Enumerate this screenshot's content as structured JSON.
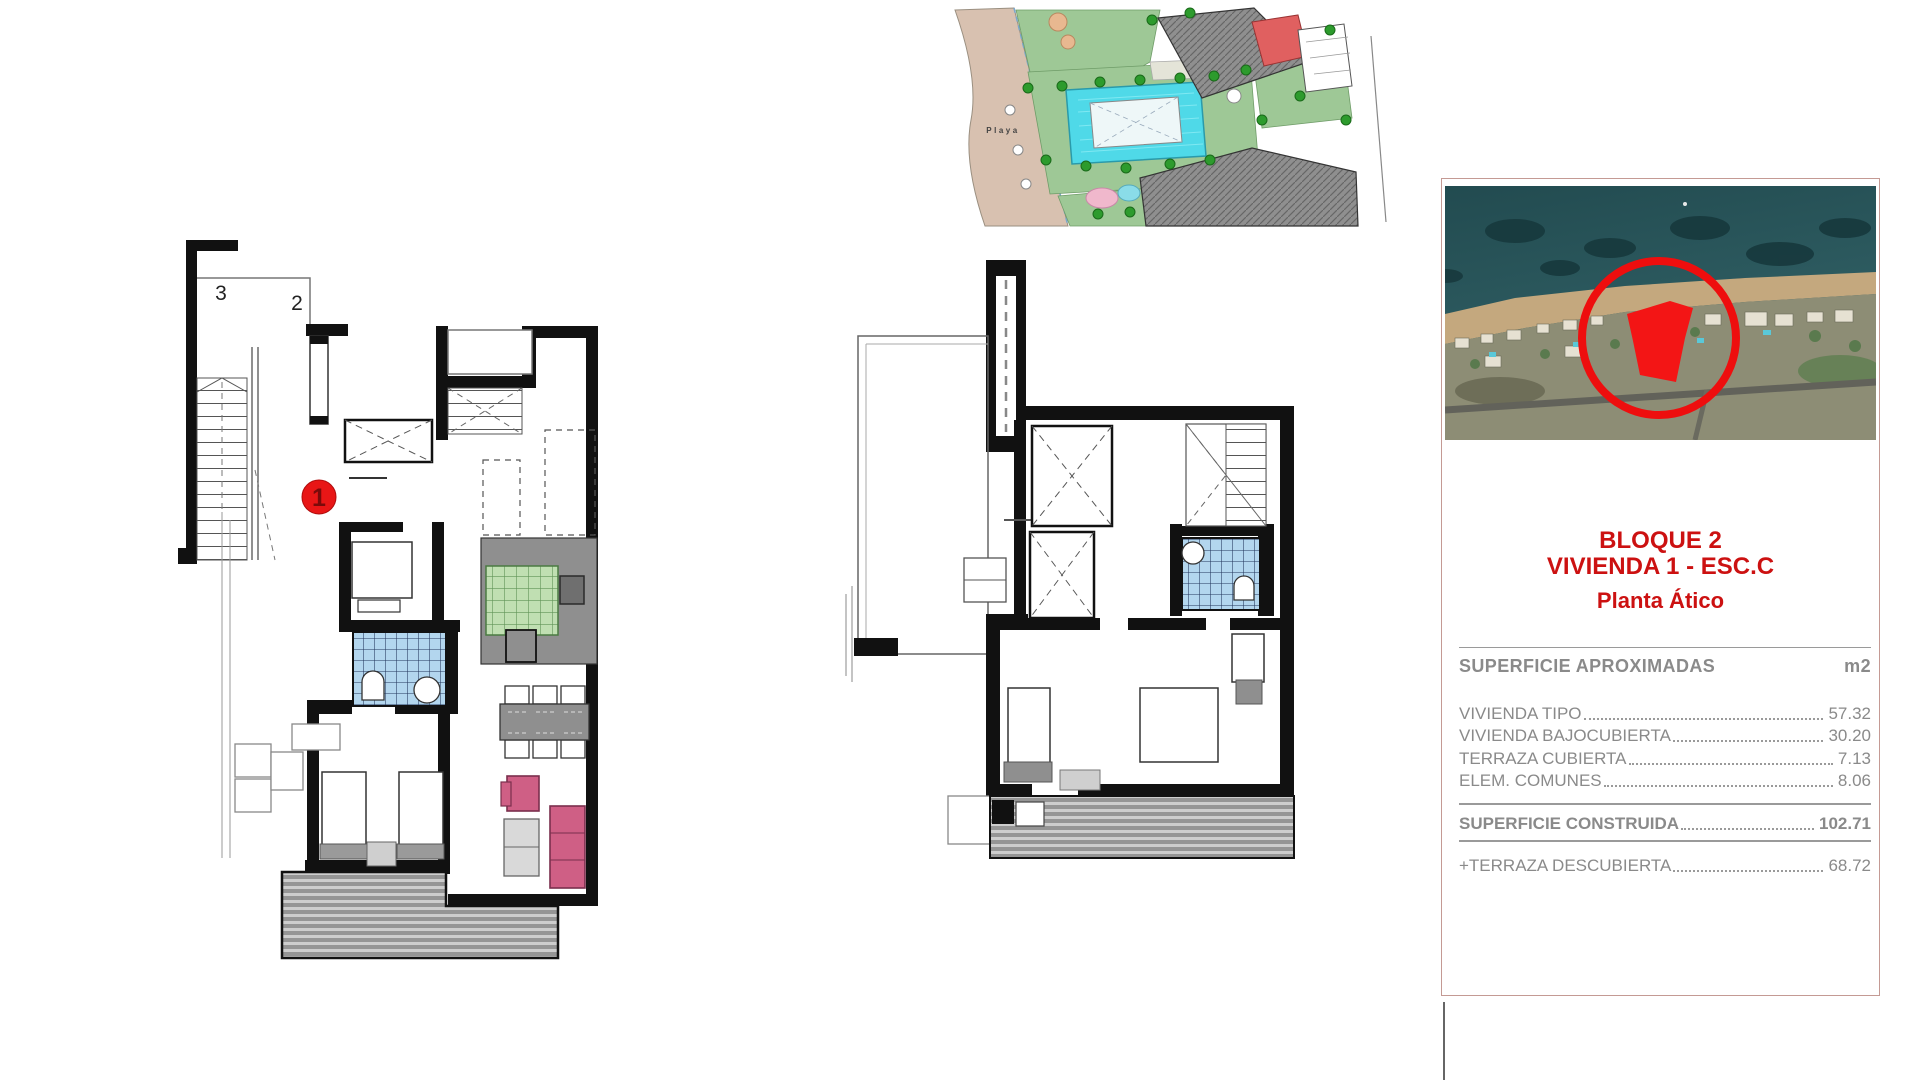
{
  "site_plan": {
    "beach_label": "Playa",
    "colors": {
      "beach": "#d8c1b0",
      "lawn": "#9ec896",
      "pool": "#4fd9e8",
      "buildings": "#8f8f8f",
      "highlight": "#e06060"
    }
  },
  "floor_plans": {
    "left": {
      "label_3": "3",
      "label_2": "2",
      "marker": "1",
      "marker_color": "#e81616",
      "tile_blue": "#b3d6ee",
      "tile_green": "#c0dfb2",
      "sofa_pink": "#cf5f85"
    },
    "middle": {}
  },
  "panel": {
    "accent_color": "#cc1111",
    "title_lines": [
      "BLOQUE 2",
      "VIVIENDA 1 - ESC.C",
      "Planta Ático"
    ],
    "table": {
      "header": {
        "label": "SUPERFICIE APROXIMADAS",
        "unit": "m2"
      },
      "rows": [
        {
          "label": "VIVIENDA TIPO",
          "value": "57.32"
        },
        {
          "label": "VIVIENDA BAJOCUBIERTA",
          "value": "30.20"
        },
        {
          "label": "TERRAZA CUBIERTA",
          "value": "7.13"
        },
        {
          "label": "ELEM. COMUNES",
          "value": "8.06"
        }
      ],
      "total": {
        "label": "SUPERFICIE CONSTRUIDA",
        "value": "102.71"
      },
      "extra": {
        "label": "+TERRAZA DESCUBIERTA",
        "value": "68.72"
      }
    }
  }
}
